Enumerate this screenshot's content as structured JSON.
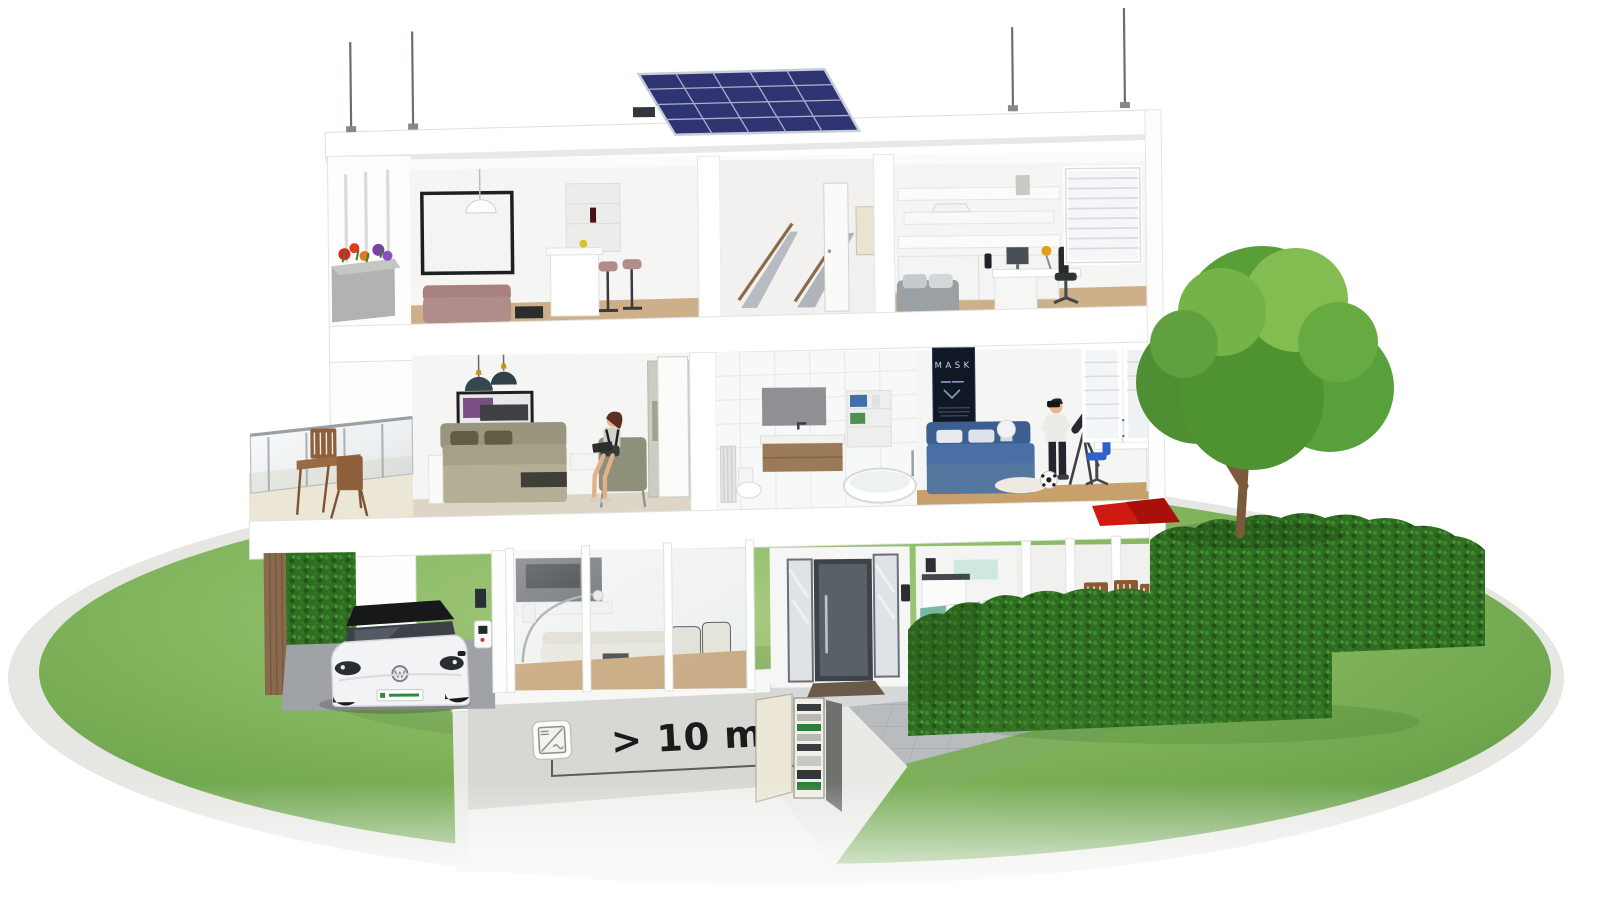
{
  "scene": {
    "name": "smart-home-cutaway-illustration",
    "annotation": {
      "distance_label": "> 10 m"
    },
    "kids_room": {
      "poster_title": "MASK"
    },
    "icons": {
      "inverter": "inverter-icon (DC/AC square with diagonal)",
      "inverter_ac_symbol": "∿",
      "inverter_dc_symbol": "=",
      "lightning_rod": "lightning-rod-icon",
      "solar_panel": "solar-panel-array"
    },
    "colors": {
      "text_dark": "#1b1b1b",
      "solar_blue": "#2e3472",
      "solar_grid": "#a9b2c9",
      "awning_red": "#cf1a12",
      "hedge_green": "#2f6d22",
      "hedge_green_dark": "#245418",
      "lawn_light": "#a8cb82",
      "lawn_mid": "#7fb35a",
      "lawn_dark": "#5f9a42",
      "tree_green": "#5a9e37",
      "tree_green_light": "#83bd52",
      "door_gray": "#596067",
      "car_white": "#f2f3f4",
      "car_roof_black": "#17181a",
      "plate_green": "#2e8b3a",
      "wood_brown": "#8a5f3a",
      "soil_gray": "#e9e9e6",
      "path_gray": "#b9bcbf",
      "bed_blue": "#4a6fa5",
      "poster_navy": "#101826"
    }
  }
}
